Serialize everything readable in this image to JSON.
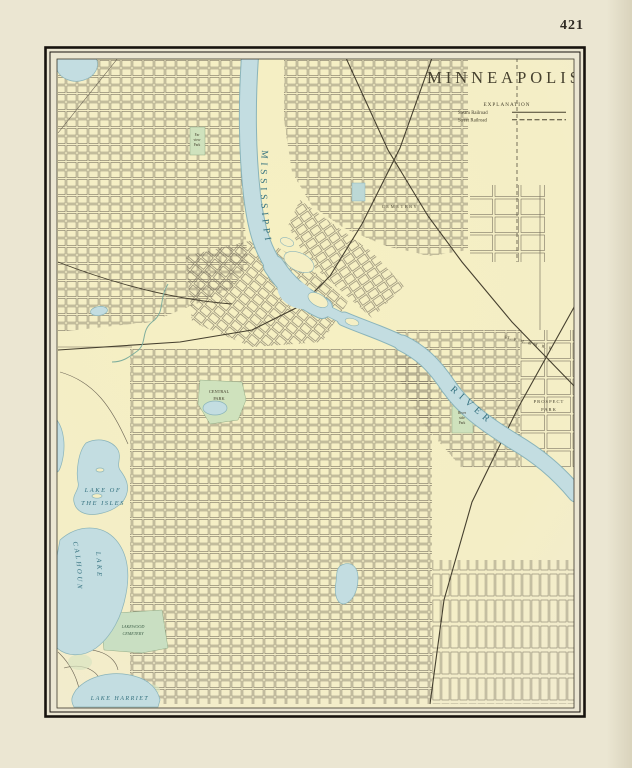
{
  "page": {
    "number": "421"
  },
  "map": {
    "title": "MINNEAPOLIS",
    "legend": {
      "heading": "EXPLANATION",
      "items": [
        {
          "label": "Steam Railroad",
          "style": "solid"
        },
        {
          "label": "Street Railroad",
          "style": "dashed"
        }
      ]
    },
    "water_labels": {
      "mississippi": "MISSISSIPPI",
      "river": "RIVER",
      "lake_of_the_isles_1": "LAKE OF",
      "lake_of_the_isles_2": "THE ISLES",
      "lake_calhoun_1": "LAKE",
      "lake_calhoun_2": "CALHOUN",
      "lake_harriet": "LAKE HARRIET"
    },
    "place_labels": {
      "central_park_1": "CENTRAL",
      "central_park_2": "PARK",
      "riverside_park_1": "River",
      "riverside_park_2": "side",
      "riverside_park_3": "Park",
      "prospect_park_1": "PROSPECT",
      "prospect_park_2": "PARK",
      "farview_park_1": "Far",
      "farview_park_2": "view",
      "farview_park_3": "Park",
      "lakewood_1": "LAKEWOOD",
      "lakewood_2": "CEMETERY",
      "cemetery": "CEMETERY",
      "railroad": "ST. P. M. & M. R. R."
    },
    "colors": {
      "paper": "#ebe6d2",
      "map_bg": "#f5efc5",
      "water": "#c3dde1",
      "water_outline": "#8ab4ba",
      "park": "#cfe2bd",
      "grid_line": "#6e6757",
      "rail": "#46402f",
      "frame": "#17130e",
      "label_dark": "#46412f",
      "label_water": "#33707e"
    }
  }
}
